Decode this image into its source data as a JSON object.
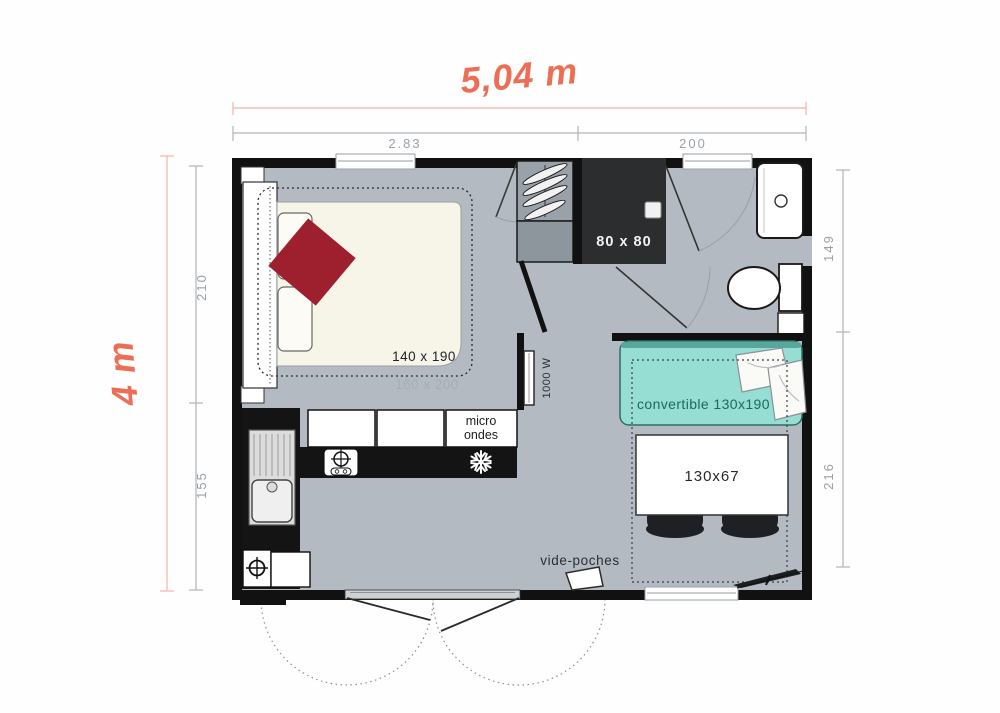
{
  "overall": {
    "width_label": "5,04 m",
    "height_label": "4 m"
  },
  "dimensions": {
    "top": [
      {
        "label": "2.83"
      },
      {
        "label": "200"
      }
    ],
    "left": [
      {
        "label": "210"
      },
      {
        "label": "155"
      }
    ],
    "right": [
      {
        "label": "149"
      },
      {
        "label": "216"
      }
    ]
  },
  "labels": {
    "bed": "140 x 190",
    "bed_zone": "160 x 200",
    "shower": "80 x 80",
    "microwave_line1": "micro",
    "microwave_line2": "ondes",
    "heater": "1000 W",
    "sofa": "convertible 130x190",
    "table": "130x67",
    "tray": "vide-poches"
  },
  "icons": {
    "freezer": "snowflake-icon",
    "hob": "crosshair-burner-icon",
    "gas_valve": "crosshair-valve-icon",
    "hangers": "clothes-hanger-icons"
  },
  "colors": {
    "accent_orange": "#ec6f55",
    "accent_orange_line": "#f2957f",
    "dim_gray": "#9ba1a7",
    "wall_black": "#111111",
    "floor_gray": "#b4bac1",
    "bed_cream": "#f7f4e8",
    "duvet_red": "#9e202e",
    "sofa_fill": "#96ded3",
    "sofa_back": "#58a79c",
    "sofa_text": "#1b6a60",
    "counter_black": "#141414",
    "shower_dark": "#2c2d2f"
  }
}
